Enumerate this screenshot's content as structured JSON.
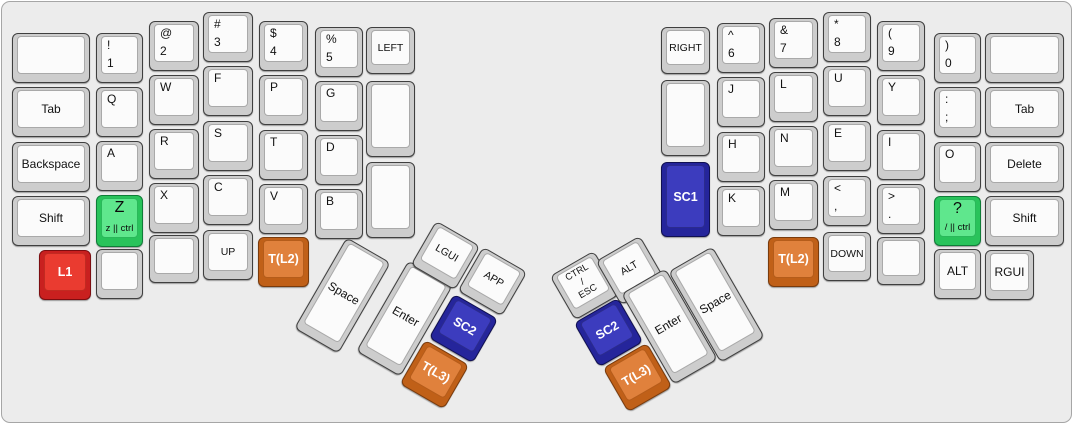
{
  "canvas": {
    "width": 1073,
    "height": 424,
    "background": "#ececec",
    "panel_border": "#a6a6a6"
  },
  "styles": {
    "default": {
      "cap": "#cdcdcd",
      "top": "#fbfbfb",
      "text": "#111111"
    },
    "green": {
      "cap": "#29c35b",
      "top": "#5fe78d",
      "text": "#0b0b0b"
    },
    "red": {
      "cap": "#c9201f",
      "top": "#ea3b30",
      "text": "#ffffff"
    },
    "blue": {
      "cap": "#25259b",
      "top": "#3c3cbe",
      "text": "#ffffff"
    },
    "orange": {
      "cap": "#c06018",
      "top": "#e0813c",
      "text": "#ffffff"
    }
  },
  "keys": [
    {
      "name": "key-blank-left-outer-top",
      "x": 10,
      "y": 31,
      "w": 78,
      "h": 50,
      "kind": "blank",
      "label": ""
    },
    {
      "name": "key-tab-left",
      "x": 10,
      "y": 85,
      "w": 78,
      "h": 50,
      "kind": "center",
      "label": "Tab"
    },
    {
      "name": "key-backspace",
      "x": 10,
      "y": 140,
      "w": 78,
      "h": 50,
      "kind": "center",
      "label": "Backspace"
    },
    {
      "name": "key-shift-left",
      "x": 10,
      "y": 194,
      "w": 78,
      "h": 50,
      "kind": "center",
      "label": "Shift"
    },
    {
      "name": "key-l1",
      "x": 37,
      "y": 248,
      "w": 52,
      "h": 50,
      "kind": "special",
      "style": "red",
      "label": "L1"
    },
    {
      "name": "key-1",
      "x": 94,
      "y": 31,
      "w": 47,
      "h": 50,
      "kind": "pair",
      "label": "!",
      "sub": "1"
    },
    {
      "name": "key-q",
      "x": 94,
      "y": 85,
      "w": 47,
      "h": 50,
      "kind": "left",
      "label": "Q"
    },
    {
      "name": "key-a",
      "x": 94,
      "y": 139,
      "w": 47,
      "h": 50,
      "kind": "left",
      "label": "A"
    },
    {
      "name": "key-z",
      "x": 94,
      "y": 193,
      "w": 47,
      "h": 52,
      "kind": "taphold",
      "style": "green",
      "label": "Z",
      "sub": "z || ctrl"
    },
    {
      "name": "key-blank-left-col2-bottom",
      "x": 94,
      "y": 247,
      "w": 47,
      "h": 50,
      "kind": "blank",
      "label": ""
    },
    {
      "name": "key-2",
      "x": 147,
      "y": 19,
      "w": 50,
      "h": 50,
      "kind": "pair",
      "label": "@",
      "sub": "2"
    },
    {
      "name": "key-w",
      "x": 147,
      "y": 73,
      "w": 50,
      "h": 50,
      "kind": "left",
      "label": "W"
    },
    {
      "name": "key-r",
      "x": 147,
      "y": 127,
      "w": 50,
      "h": 50,
      "kind": "left",
      "label": "R"
    },
    {
      "name": "key-x",
      "x": 147,
      "y": 181,
      "w": 50,
      "h": 50,
      "kind": "left",
      "label": "X"
    },
    {
      "name": "key-blank-left-col3-bottom",
      "x": 147,
      "y": 233,
      "w": 50,
      "h": 48,
      "kind": "blank",
      "label": ""
    },
    {
      "name": "key-3",
      "x": 201,
      "y": 10,
      "w": 50,
      "h": 50,
      "kind": "pair",
      "label": "#",
      "sub": "3"
    },
    {
      "name": "key-f",
      "x": 201,
      "y": 64,
      "w": 50,
      "h": 50,
      "kind": "left",
      "label": "F"
    },
    {
      "name": "key-s",
      "x": 201,
      "y": 119,
      "w": 50,
      "h": 50,
      "kind": "left",
      "label": "S"
    },
    {
      "name": "key-c",
      "x": 201,
      "y": 173,
      "w": 50,
      "h": 50,
      "kind": "left",
      "label": "C"
    },
    {
      "name": "key-up",
      "x": 201,
      "y": 228,
      "w": 50,
      "h": 50,
      "kind": "arrow",
      "label": "UP"
    },
    {
      "name": "key-4",
      "x": 257,
      "y": 19,
      "w": 49,
      "h": 50,
      "kind": "pair",
      "label": "$",
      "sub": "4"
    },
    {
      "name": "key-p",
      "x": 257,
      "y": 73,
      "w": 49,
      "h": 50,
      "kind": "left",
      "label": "P"
    },
    {
      "name": "key-t",
      "x": 257,
      "y": 128,
      "w": 49,
      "h": 50,
      "kind": "left",
      "label": "T"
    },
    {
      "name": "key-v",
      "x": 257,
      "y": 182,
      "w": 49,
      "h": 50,
      "kind": "left",
      "label": "V"
    },
    {
      "name": "key-t-l2-left",
      "x": 256,
      "y": 235,
      "w": 51,
      "h": 50,
      "kind": "special",
      "style": "orange",
      "label": "T(L2)"
    },
    {
      "name": "key-5",
      "x": 313,
      "y": 25,
      "w": 48,
      "h": 50,
      "kind": "pair",
      "label": "%",
      "sub": "5"
    },
    {
      "name": "key-g",
      "x": 313,
      "y": 79,
      "w": 48,
      "h": 50,
      "kind": "left",
      "label": "G"
    },
    {
      "name": "key-d",
      "x": 313,
      "y": 133,
      "w": 48,
      "h": 50,
      "kind": "left",
      "label": "D"
    },
    {
      "name": "key-b",
      "x": 313,
      "y": 187,
      "w": 48,
      "h": 50,
      "kind": "left",
      "label": "B"
    },
    {
      "name": "key-left-arrow",
      "x": 364,
      "y": 25,
      "w": 49,
      "h": 47,
      "kind": "arrow",
      "label": "LEFT"
    },
    {
      "name": "key-blank-left-col7-mid",
      "x": 364,
      "y": 79,
      "w": 49,
      "h": 76,
      "kind": "blank",
      "label": ""
    },
    {
      "name": "key-blank-left-col7-bottom",
      "x": 364,
      "y": 160,
      "w": 49,
      "h": 76,
      "kind": "blank",
      "label": ""
    },
    {
      "name": "key-space-left",
      "x": 315,
      "y": 241,
      "w": 51,
      "h": 105,
      "rot": 30,
      "kind": "center",
      "label": "Space"
    },
    {
      "name": "key-enter-left",
      "x": 377,
      "y": 264,
      "w": 51,
      "h": 105,
      "rot": 30,
      "kind": "center",
      "label": "Enter"
    },
    {
      "name": "key-lgui",
      "x": 418,
      "y": 228,
      "w": 51,
      "h": 51,
      "rot": 30,
      "kind": "arrow",
      "label": "LGUI"
    },
    {
      "name": "key-app",
      "x": 465,
      "y": 254,
      "w": 51,
      "h": 51,
      "rot": 30,
      "kind": "arrow",
      "label": "APP"
    },
    {
      "name": "key-sc2-left",
      "x": 436,
      "y": 301,
      "w": 51,
      "h": 51,
      "rot": 30,
      "kind": "special",
      "style": "blue",
      "label": "SC2"
    },
    {
      "name": "key-t-l3-left",
      "x": 407,
      "y": 347,
      "w": 51,
      "h": 51,
      "rot": 30,
      "kind": "special",
      "style": "orange",
      "label": "T(L3)"
    },
    {
      "name": "key-ctrl-esc",
      "x": 557,
      "y": 258,
      "w": 51,
      "h": 51,
      "rot": -30,
      "kind": "multi",
      "label": "CTRL\n/\nESC"
    },
    {
      "name": "key-alt-right-thumb",
      "x": 603,
      "y": 243,
      "w": 51,
      "h": 51,
      "rot": -30,
      "kind": "arrow",
      "label": "ALT"
    },
    {
      "name": "key-sc2-right",
      "x": 581,
      "y": 305,
      "w": 51,
      "h": 51,
      "rot": -30,
      "kind": "special",
      "style": "blue",
      "label": "SC2"
    },
    {
      "name": "key-t-l3-right",
      "x": 610,
      "y": 350,
      "w": 51,
      "h": 51,
      "rot": -30,
      "kind": "special",
      "style": "orange",
      "label": "T(L3)"
    },
    {
      "name": "key-enter-right",
      "x": 642,
      "y": 272,
      "w": 51,
      "h": 105,
      "rot": -30,
      "kind": "center",
      "label": "Enter"
    },
    {
      "name": "key-space-right",
      "x": 689,
      "y": 250,
      "w": 51,
      "h": 105,
      "rot": -30,
      "kind": "center",
      "label": "Space"
    },
    {
      "name": "key-right-arrow",
      "x": 659,
      "y": 25,
      "w": 49,
      "h": 47,
      "kind": "arrow",
      "label": "RIGHT"
    },
    {
      "name": "key-blank-right-col1-mid",
      "x": 659,
      "y": 78,
      "w": 49,
      "h": 76,
      "kind": "blank",
      "label": ""
    },
    {
      "name": "key-sc1",
      "x": 659,
      "y": 160,
      "w": 49,
      "h": 75,
      "kind": "special",
      "style": "blue",
      "label": "SC1"
    },
    {
      "name": "key-6",
      "x": 715,
      "y": 21,
      "w": 48,
      "h": 50,
      "kind": "pair",
      "label": "^",
      "sub": "6"
    },
    {
      "name": "key-j",
      "x": 715,
      "y": 75,
      "w": 48,
      "h": 50,
      "kind": "left",
      "label": "J"
    },
    {
      "name": "key-h",
      "x": 715,
      "y": 130,
      "w": 48,
      "h": 50,
      "kind": "left",
      "label": "H"
    },
    {
      "name": "key-k",
      "x": 715,
      "y": 184,
      "w": 48,
      "h": 50,
      "kind": "left",
      "label": "K"
    },
    {
      "name": "key-7",
      "x": 767,
      "y": 16,
      "w": 49,
      "h": 50,
      "kind": "pair",
      "label": "&",
      "sub": "7"
    },
    {
      "name": "key-l",
      "x": 767,
      "y": 70,
      "w": 49,
      "h": 50,
      "kind": "left",
      "label": "L"
    },
    {
      "name": "key-n",
      "x": 767,
      "y": 124,
      "w": 49,
      "h": 50,
      "kind": "left",
      "label": "N"
    },
    {
      "name": "key-m",
      "x": 767,
      "y": 178,
      "w": 49,
      "h": 50,
      "kind": "left",
      "label": "M"
    },
    {
      "name": "key-t-l2-right",
      "x": 766,
      "y": 235,
      "w": 51,
      "h": 50,
      "kind": "special",
      "style": "orange",
      "label": "T(L2)"
    },
    {
      "name": "key-8",
      "x": 821,
      "y": 10,
      "w": 48,
      "h": 50,
      "kind": "pair",
      "label": "*",
      "sub": "8"
    },
    {
      "name": "key-u",
      "x": 821,
      "y": 64,
      "w": 48,
      "h": 50,
      "kind": "left",
      "label": "U"
    },
    {
      "name": "key-e",
      "x": 821,
      "y": 119,
      "w": 48,
      "h": 50,
      "kind": "left",
      "label": "E"
    },
    {
      "name": "key-comma",
      "x": 821,
      "y": 174,
      "w": 48,
      "h": 50,
      "kind": "pair",
      "label": "<",
      "sub": ","
    },
    {
      "name": "key-down",
      "x": 821,
      "y": 230,
      "w": 48,
      "h": 49,
      "kind": "arrow",
      "label": "DOWN"
    },
    {
      "name": "key-9",
      "x": 875,
      "y": 19,
      "w": 48,
      "h": 50,
      "kind": "pair",
      "label": "(",
      "sub": "9"
    },
    {
      "name": "key-y",
      "x": 875,
      "y": 73,
      "w": 48,
      "h": 50,
      "kind": "left",
      "label": "Y"
    },
    {
      "name": "key-i",
      "x": 875,
      "y": 128,
      "w": 48,
      "h": 50,
      "kind": "left",
      "label": "I"
    },
    {
      "name": "key-period",
      "x": 875,
      "y": 182,
      "w": 48,
      "h": 50,
      "kind": "pair",
      "label": ">",
      "sub": "."
    },
    {
      "name": "key-blank-right-col5-bottom",
      "x": 875,
      "y": 235,
      "w": 48,
      "h": 48,
      "kind": "blank",
      "label": ""
    },
    {
      "name": "key-0",
      "x": 932,
      "y": 31,
      "w": 47,
      "h": 50,
      "kind": "pair",
      "label": ")",
      "sub": "0"
    },
    {
      "name": "key-semicolon",
      "x": 932,
      "y": 85,
      "w": 47,
      "h": 50,
      "kind": "pair",
      "label": ":",
      "sub": ";"
    },
    {
      "name": "key-o",
      "x": 932,
      "y": 140,
      "w": 47,
      "h": 50,
      "kind": "left",
      "label": "O"
    },
    {
      "name": "key-slash",
      "x": 932,
      "y": 194,
      "w": 47,
      "h": 50,
      "kind": "taphold",
      "style": "green",
      "label": "?",
      "sub": "/ || ctrl"
    },
    {
      "name": "key-alt-right",
      "x": 932,
      "y": 247,
      "w": 47,
      "h": 50,
      "kind": "center",
      "label": "ALT"
    },
    {
      "name": "key-blank-right-outer-top",
      "x": 983,
      "y": 31,
      "w": 79,
      "h": 50,
      "kind": "blank",
      "label": ""
    },
    {
      "name": "key-tab-right",
      "x": 983,
      "y": 85,
      "w": 79,
      "h": 50,
      "kind": "center",
      "label": "Tab"
    },
    {
      "name": "key-delete",
      "x": 983,
      "y": 140,
      "w": 79,
      "h": 50,
      "kind": "center",
      "label": "Delete"
    },
    {
      "name": "key-shift-right",
      "x": 983,
      "y": 194,
      "w": 79,
      "h": 50,
      "kind": "center",
      "label": "Shift"
    },
    {
      "name": "key-rgui",
      "x": 983,
      "y": 248,
      "w": 49,
      "h": 50,
      "kind": "center",
      "label": "RGUI"
    }
  ]
}
